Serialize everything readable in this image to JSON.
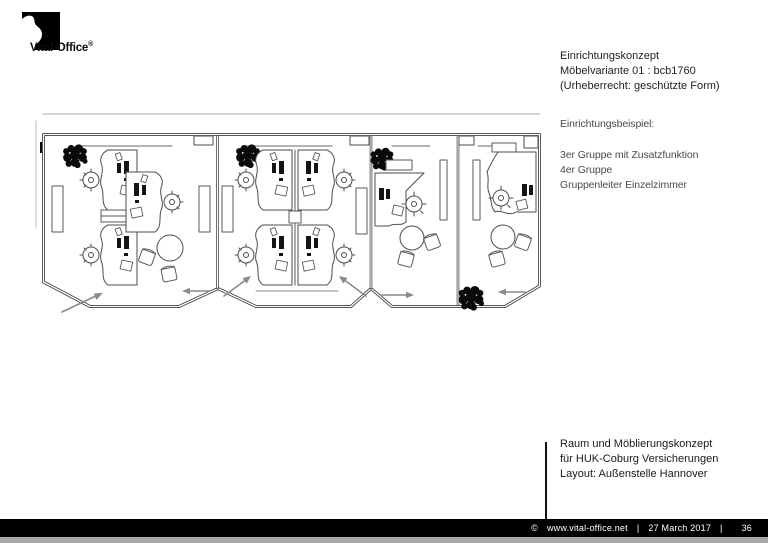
{
  "logo": {
    "text": "Vital-Office",
    "registered_mark": "®",
    "mark_color": "#000000"
  },
  "title_block": {
    "lines": [
      "Einrichtungskonzept",
      "Möbelvariante 01 : bcb1760",
      "(Urheberrecht: geschützte Form)"
    ]
  },
  "example_block": {
    "heading": "Einrichtungsbeispiel:",
    "items": [
      "3er Gruppe mit Zusatzfunktion",
      "4er Gruppe",
      "Gruppenleiter Einzelzimmer"
    ]
  },
  "project_block": {
    "lines": [
      "Raum und Möblierungskonzept",
      "für HUK-Coburg Versicherungen",
      "Layout: Außenstelle Hannover"
    ]
  },
  "footer": {
    "copyright_symbol": "©",
    "website": "www.vital-office.net",
    "separator": "|",
    "date": "27 March 2017",
    "page_number": "36",
    "background": "#000000",
    "text_color": "#ffffff"
  },
  "floor_plan": {
    "rooms": 4,
    "wall_color": "#3d3d3d",
    "furniture_line_color": "#4d4d4d",
    "door_arrow_color": "#8a8a8a",
    "plant_color": "#0a0a0a"
  }
}
